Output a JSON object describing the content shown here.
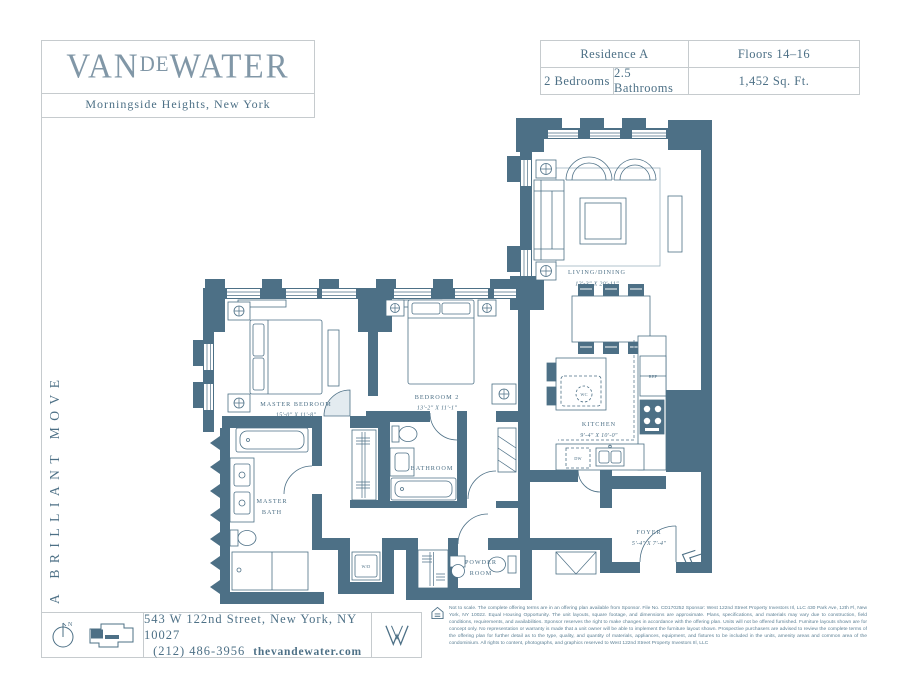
{
  "colors": {
    "accent": "#4d7086",
    "logo": "#8197a7",
    "border": "#c6cbce"
  },
  "brand": {
    "logo_pre": "VAN",
    "logo_mid": "DE",
    "logo_post": "WATER",
    "subtitle": "Morningside Heights, New York",
    "tagline": "A BRILLIANT MOVE"
  },
  "info_table": {
    "residence": "Residence A",
    "floors": "Floors 14–16",
    "bedrooms": "2 Bedrooms",
    "bathrooms": "2.5 Bathrooms",
    "area": "1,452 Sq. Ft."
  },
  "plan": {
    "rooms": {
      "master_bedroom": {
        "name": "MASTER BEDROOM",
        "dims": "15'-0\" X 11'-8\""
      },
      "bedroom2": {
        "name": "BEDROOM 2",
        "dims": "13'-2\" X 11'-1\""
      },
      "living_dining": {
        "name": "LIVING/DINING",
        "dims": "12'-3\" X 20'-11\""
      },
      "kitchen": {
        "name": "KITCHEN",
        "dims": "9'-4\" X 10'-0\""
      },
      "master_bath": {
        "line1": "MASTER",
        "line2": "BATH"
      },
      "bathroom": {
        "name": "BATHROOM"
      },
      "powder_room": {
        "line1": "POWDER",
        "line2": "ROOM"
      },
      "foyer": {
        "name": "FOYER",
        "dims": "5'-4\" X 7'-4\""
      }
    },
    "appliances": {
      "wd": "W/D",
      "ref": "REF",
      "wc": "WC",
      "dw": "DW"
    },
    "compass_north": "N"
  },
  "footer": {
    "address": "543 W 122nd Street, New York, NY 10027",
    "phone": "(212) 486-3956",
    "website": "thevandewater.com",
    "disclaimer": "Not to scale. The complete offering terms are in an offering plan available from Sponsor. File No. CD170252 Sponsor: West 122nd Street Property Investors IIl, LLC 430 Park Ave, 12th Fl, New York, NY 10022. Equal Housing Opportunity. The unit layouts, square footage, and dimensions are approximate. Plans, specifications, and materials may vary due to construction, field conditions, requirements, and availabilities. Sponsor reserves the right to make changes in accordance with the offering plan. Units will not be offered furnished. Furniture layouts shown are for concept only. No representation or warranty is made that a unit owner will be able to implement the furniture layout shown. Prospective purchasers are advised to review the complete terms of the offering plan for further detail as to the type, quality, and quantity of materials, appliances, equipment, and fixtures to be included in the units, amenity areas and common area of the condominium. All rights to content, photographs, and graphics reserved to West 122nd Street Property Investors IIl, LLC"
  }
}
